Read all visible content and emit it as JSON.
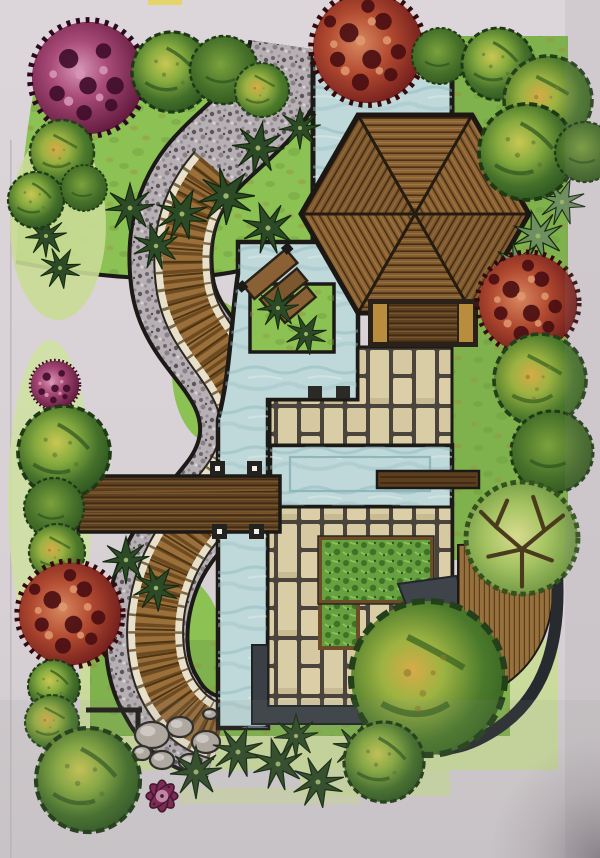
{
  "scene": {
    "subject": "Hand-drawn marker rendering of a landscape garden plan: hexagonal wooden pavilion, blue ponds and water channels, S-curved gravel path with wooden boardwalk, paver decks, hedges, bridge, rocks and perimeter planting",
    "trees": [
      {
        "kind": "magenta",
        "x": 88,
        "y": 78,
        "r": 58
      },
      {
        "kind": "green-a",
        "x": 172,
        "y": 72,
        "r": 40
      },
      {
        "kind": "green-c",
        "x": 224,
        "y": 70,
        "r": 34
      },
      {
        "kind": "green-b",
        "x": 262,
        "y": 90,
        "r": 27
      },
      {
        "kind": "red",
        "x": 368,
        "y": 48,
        "r": 57
      },
      {
        "kind": "green-c",
        "x": 440,
        "y": 56,
        "r": 28
      },
      {
        "kind": "green-a",
        "x": 498,
        "y": 64,
        "r": 36
      },
      {
        "kind": "green-b",
        "x": 548,
        "y": 100,
        "r": 44
      },
      {
        "kind": "green-a",
        "x": 527,
        "y": 152,
        "r": 48
      },
      {
        "kind": "green-c",
        "x": 585,
        "y": 152,
        "r": 30
      },
      {
        "kind": "green-b",
        "x": 62,
        "y": 152,
        "r": 32
      },
      {
        "kind": "green-a",
        "x": 36,
        "y": 200,
        "r": 28
      },
      {
        "kind": "green-c",
        "x": 84,
        "y": 188,
        "r": 23
      },
      {
        "kind": "magenta",
        "x": 55,
        "y": 385,
        "r": 25
      },
      {
        "kind": "green-a",
        "x": 64,
        "y": 452,
        "r": 46
      },
      {
        "kind": "green-c",
        "x": 54,
        "y": 508,
        "r": 30
      },
      {
        "kind": "green-b",
        "x": 57,
        "y": 552,
        "r": 28
      },
      {
        "kind": "red",
        "x": 70,
        "y": 614,
        "r": 53
      },
      {
        "kind": "green-a",
        "x": 54,
        "y": 686,
        "r": 26
      },
      {
        "kind": "green-b",
        "x": 52,
        "y": 722,
        "r": 27
      },
      {
        "kind": "green-a",
        "x": 88,
        "y": 780,
        "r": 52
      },
      {
        "kind": "flower",
        "x": 162,
        "y": 796,
        "r": 34
      },
      {
        "kind": "red",
        "x": 528,
        "y": 303,
        "r": 51
      },
      {
        "kind": "green-b",
        "x": 540,
        "y": 380,
        "r": 46
      },
      {
        "kind": "green-c",
        "x": 552,
        "y": 452,
        "r": 41
      },
      {
        "kind": "leafy",
        "x": 522,
        "y": 538,
        "r": 56
      },
      {
        "kind": "green-b",
        "x": 428,
        "y": 678,
        "r": 77
      },
      {
        "kind": "green-a",
        "x": 384,
        "y": 762,
        "r": 40
      }
    ],
    "plants": [
      {
        "x": 258,
        "y": 148,
        "s": 1.0,
        "rot": 10,
        "tone": "dark"
      },
      {
        "x": 300,
        "y": 128,
        "s": 0.8,
        "rot": 0,
        "tone": "dark"
      },
      {
        "x": 226,
        "y": 196,
        "s": 1.1,
        "rot": 40,
        "tone": "dark"
      },
      {
        "x": 268,
        "y": 228,
        "s": 1.0,
        "rot": -20,
        "tone": "dark"
      },
      {
        "x": 130,
        "y": 208,
        "s": 0.95,
        "rot": 0,
        "tone": "dark"
      },
      {
        "x": 182,
        "y": 214,
        "s": 1.0,
        "rot": 25,
        "tone": "dark"
      },
      {
        "x": 156,
        "y": 246,
        "s": 0.9,
        "rot": -15,
        "tone": "dark"
      },
      {
        "x": 46,
        "y": 236,
        "s": 0.8,
        "rot": 0,
        "tone": "dark"
      },
      {
        "x": 60,
        "y": 268,
        "s": 0.8,
        "rot": 30,
        "tone": "dark"
      },
      {
        "x": 545,
        "y": 165,
        "s": 0.95,
        "rot": 0,
        "tone": "light"
      },
      {
        "x": 562,
        "y": 202,
        "s": 0.9,
        "rot": 20,
        "tone": "light"
      },
      {
        "x": 538,
        "y": 236,
        "s": 1.0,
        "rot": -15,
        "tone": "light"
      },
      {
        "x": 518,
        "y": 266,
        "s": 0.95,
        "rot": 40,
        "tone": "light"
      },
      {
        "x": 548,
        "y": 292,
        "s": 0.85,
        "rot": 10,
        "tone": "light"
      },
      {
        "x": 278,
        "y": 308,
        "s": 0.8,
        "rot": 0,
        "tone": "dark"
      },
      {
        "x": 306,
        "y": 334,
        "s": 0.8,
        "rot": 30,
        "tone": "dark"
      },
      {
        "x": 126,
        "y": 560,
        "s": 0.9,
        "rot": 0,
        "tone": "dark"
      },
      {
        "x": 156,
        "y": 588,
        "s": 0.9,
        "rot": 35,
        "tone": "dark"
      },
      {
        "x": 196,
        "y": 772,
        "s": 1.0,
        "rot": 0,
        "tone": "dark"
      },
      {
        "x": 238,
        "y": 752,
        "s": 1.0,
        "rot": 20,
        "tone": "dark"
      },
      {
        "x": 278,
        "y": 764,
        "s": 1.0,
        "rot": -15,
        "tone": "dark"
      },
      {
        "x": 318,
        "y": 782,
        "s": 1.0,
        "rot": 30,
        "tone": "dark"
      },
      {
        "x": 296,
        "y": 736,
        "s": 0.85,
        "rot": 0,
        "tone": "dark"
      },
      {
        "x": 356,
        "y": 748,
        "s": 0.9,
        "rot": 15,
        "tone": "dark"
      }
    ],
    "rocks": [
      {
        "x": 152,
        "y": 735,
        "rx": 17,
        "ry": 13
      },
      {
        "x": 180,
        "y": 727,
        "rx": 13,
        "ry": 10
      },
      {
        "x": 206,
        "y": 742,
        "rx": 14,
        "ry": 11
      },
      {
        "x": 162,
        "y": 760,
        "rx": 12,
        "ry": 9
      },
      {
        "x": 190,
        "y": 762,
        "rx": 11,
        "ry": 8
      },
      {
        "x": 142,
        "y": 753,
        "rx": 9,
        "ry": 7
      },
      {
        "x": 210,
        "y": 714,
        "rx": 7,
        "ry": 5
      }
    ]
  },
  "palette": {
    "paper": "#d9d3d7",
    "paperLow": "#d1cbce",
    "lawnBright": "#8cc154",
    "lawnMid": "#7fb24c",
    "lawnPale": "#c9dc96",
    "water": "#bfd8da",
    "waterLine": "#8fb6ba",
    "outline": "#1c1a17",
    "gravel": "#b6afb3",
    "cream": "#e8e0cb",
    "tick": "#7b6a48",
    "plank": "#9a6f3a",
    "plankDark": "#6d4b22",
    "plankDeep": "#4c3312",
    "woodDark": "#5f4222",
    "paverJoint": "#4a443c",
    "paver": "#d9cda6",
    "hedge": "#67a03e",
    "darkBand": "#3a4046",
    "deckCurve": "#272b30",
    "stoneWalk": "#3f444b",
    "rightDeck": "#96713d",
    "rock": "#b3aca4",
    "spikyDark": "#2d4a26",
    "spikyLight": "#6e8f5e",
    "pavilionWood": "#8a6134",
    "pavilionLine": "#4c3115"
  }
}
